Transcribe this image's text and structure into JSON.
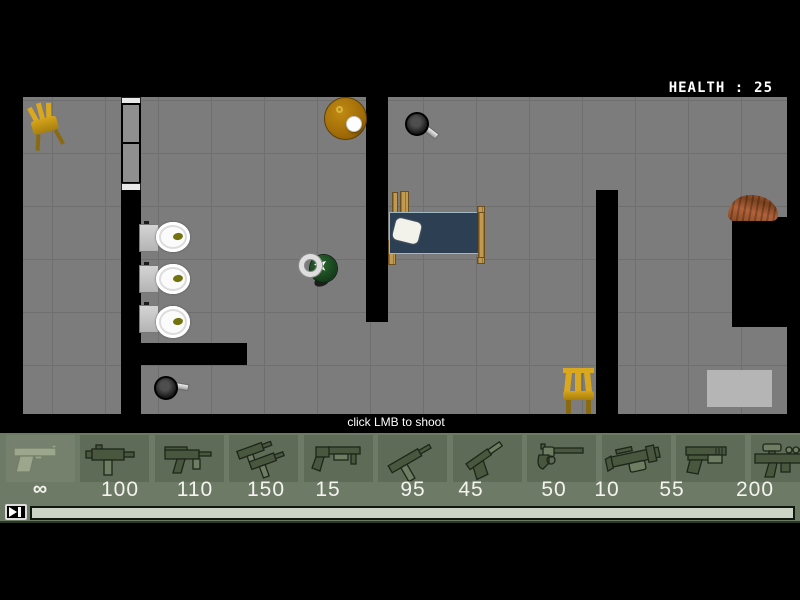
{
  "hud": {
    "health_label": "HEALTH :",
    "health_value": "25",
    "hint_text": "click LMB to shoot"
  },
  "map": {
    "objects": [
      "chair",
      "sliding-door",
      "round-table-with-lamp",
      "frying-pan",
      "bed-with-pillow",
      "toilet",
      "toilet",
      "toilet",
      "frying-pan",
      "player-character",
      "chair",
      "wood-pile",
      "rug"
    ]
  },
  "colors": {
    "floor": "#7c7c7c",
    "grid_line": "#6f6f6f",
    "wall": "#000000",
    "bar_background": "#6d7a66",
    "tile_background": "#5d6b57",
    "ammo_text": "#f4f4ef",
    "health_text": "#ffffff"
  },
  "weapons": [
    {
      "name": "desert-eagle-pistol",
      "ammo": "∞",
      "selected": true
    },
    {
      "name": "mac-10-smg",
      "ammo": "100",
      "selected": false
    },
    {
      "name": "mp5k-smg",
      "ammo": "110",
      "selected": false
    },
    {
      "name": "dual-uzis",
      "ammo": "150",
      "selected": false
    },
    {
      "name": "pump-shotgun",
      "ammo": "15",
      "selected": false
    },
    {
      "name": "tec-9-smg",
      "ammo": "95",
      "selected": false
    },
    {
      "name": "suppressed-pistol",
      "ammo": "45",
      "selected": false
    },
    {
      "name": "revolver",
      "ammo": "50",
      "selected": false
    },
    {
      "name": "grenade-launcher",
      "ammo": "10",
      "selected": false
    },
    {
      "name": "tactical-pistol",
      "ammo": "55",
      "selected": false
    },
    {
      "name": "scoped-rifle",
      "ammo": "200",
      "selected": false
    }
  ]
}
